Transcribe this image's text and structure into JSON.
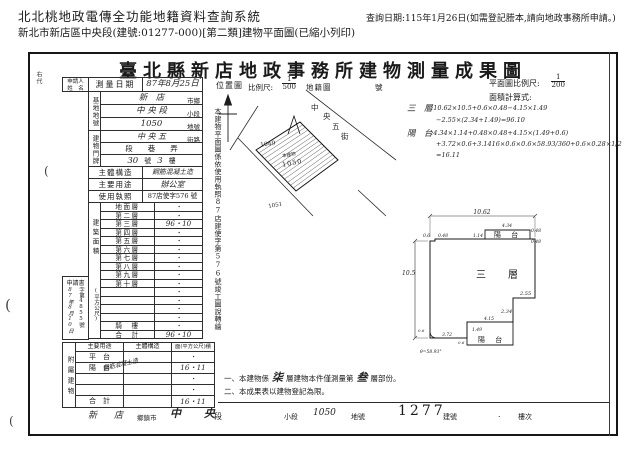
{
  "header": {
    "system_title": "北北桃地政電傳全功能地籍資料查詢系統",
    "query_date": "查詢日期:115年1月26日(如需登記謄本,請向地政事務所申請。)",
    "subtitle": "新北市新店區中央段(建號:01277-000)[第二類]建物平面圖(已縮小列印)"
  },
  "doc": {
    "title": "臺北縣新店地政事務所建物測量成果圖",
    "side_code": "右代",
    "margin_mark": "(",
    "applicant": {
      "line1": "申請人",
      "line2": "姓　名"
    },
    "survey": {
      "label": "測量日期",
      "value": "87年8月25日"
    },
    "site": {
      "label": "基地地號",
      "rows": [
        {
          "value": "新　店",
          "unit": "市鄉"
        },
        {
          "value": "中 央 段",
          "unit": "小段"
        },
        {
          "value": "1050",
          "unit": "地號"
        }
      ]
    },
    "door": {
      "label": "建物門牌",
      "street": {
        "value": "中 央 五",
        "unit": "街路"
      },
      "mid": "段　　巷　　弄",
      "number": {
        "v1": "30",
        "u1": "號",
        "v2": "3",
        "u2": "樓"
      }
    },
    "info": [
      {
        "label": "主體構造",
        "value": "鋼筋混凝土造"
      },
      {
        "label": "主要用途",
        "value": "辦公室"
      },
      {
        "label": "使用執照",
        "value": "87店使字576 號"
      }
    ],
    "area": {
      "label_top": "建築面積",
      "label_unit": "(平方公尺)",
      "floors": [
        {
          "label": "地面層",
          "value": "・"
        },
        {
          "label": "第二層",
          "value": "・"
        },
        {
          "label": "第三層",
          "value": "96・10"
        },
        {
          "label": "第四層",
          "value": "・"
        },
        {
          "label": "第五層",
          "value": "・"
        },
        {
          "label": "第六層",
          "value": "・"
        },
        {
          "label": "第七層",
          "value": "・"
        },
        {
          "label": "第八層",
          "value": "・"
        },
        {
          "label": "第九層",
          "value": "・"
        },
        {
          "label": "第十層",
          "value": "・"
        },
        {
          "label": "",
          "value": "・"
        },
        {
          "label": "",
          "value": "・"
        },
        {
          "label": "",
          "value": "・"
        },
        {
          "label": "",
          "value": "・"
        },
        {
          "label": "騎　樓",
          "value": "・"
        },
        {
          "label": "合　計",
          "value": "96・10"
        }
      ]
    },
    "application": {
      "title": "申請書",
      "date": "87年8月10日",
      "no": "字第4855號"
    },
    "annex": {
      "side_label": "附屬建物",
      "headers": {
        "use": "主要用途",
        "structure": "主體構造",
        "area": "面(平方公尺)積"
      },
      "rows": [
        {
          "use": "平　台",
          "structure": "",
          "area": "・"
        },
        {
          "use": "陽　台",
          "structure": "鋼筋混凝土造",
          "area": "16・11"
        },
        {
          "use": "",
          "structure": "",
          "area": "・"
        },
        {
          "use": "",
          "structure": "",
          "area": "・"
        },
        {
          "use": "合　計",
          "structure": "",
          "area": "16・11"
        }
      ]
    },
    "vertical_note": "本建物平面圖係依使用執照87店建使字第576號竣工圖說轉繪",
    "location_map": {
      "label": "位置圖",
      "scale_label": "比例尺:",
      "scale_num": "1",
      "scale_den": "500",
      "cadastral_label": "地籍圖",
      "sheet_label": "號",
      "street_chars": {
        "c1": "中",
        "c2": "央",
        "c3": "五",
        "c4": "街"
      },
      "parcel_1049": "1049",
      "parcel_1050": "1050",
      "parcel_1051": "1051",
      "building_tag": "本建物"
    },
    "plan": {
      "scale_label": "平面圖比例尺:",
      "scale_num": "1",
      "scale_den": "200",
      "calc_label": "面積計算式:",
      "floor_formula": {
        "label": "三　層",
        "line1": ":10.62×10.5+0.6×0.48−4.15×1.49",
        "line2": "−2.55×(2.34+1.49)=96.10"
      },
      "balcony_formula": {
        "label": "陽　台",
        "line1": ":4.34×1.14+0.48×0.48+4.15×(1.49+0.6)",
        "line2": "+3.72×0.6+3.1416×0.6×0.6×58.93/360+0.6×0.28×1/2",
        "line3": "=16.11"
      },
      "room_label": "三　層",
      "balcony_top_label": "陽 台",
      "balcony_bottom_label": "陽 台",
      "dims": {
        "top": "10.62",
        "left": "10.5",
        "n1": "0.6",
        "n2": "0.48",
        "bt_l": "1.14",
        "bt_t": "4.34",
        "bt_r1": "0.48",
        "bt_r2": "0.48",
        "step1": "2.55",
        "step2": "2.34",
        "bb_t": "4.15",
        "bb_l": "1.49",
        "bb_w": "3.72",
        "bb_s": "0.6",
        "corner": "0.6",
        "angle": "θ=58.93°"
      }
    },
    "notes": {
      "n1a": "一、本建物係",
      "n1b": "柒",
      "n1c": "層建物本件僅測量第",
      "n1d": "叁",
      "n1e": "層部份。",
      "n2": "二、本成果表以建物登記為限。"
    },
    "footer": {
      "v1": "新　店",
      "u1": "鄉鎮市",
      "v2": "中　央",
      "u2": "段",
      "u3": "小段",
      "v3": "1050",
      "u4": "地號",
      "v4": "1277",
      "u5": "建號",
      "dot": ".",
      "u6": "樓次"
    }
  }
}
